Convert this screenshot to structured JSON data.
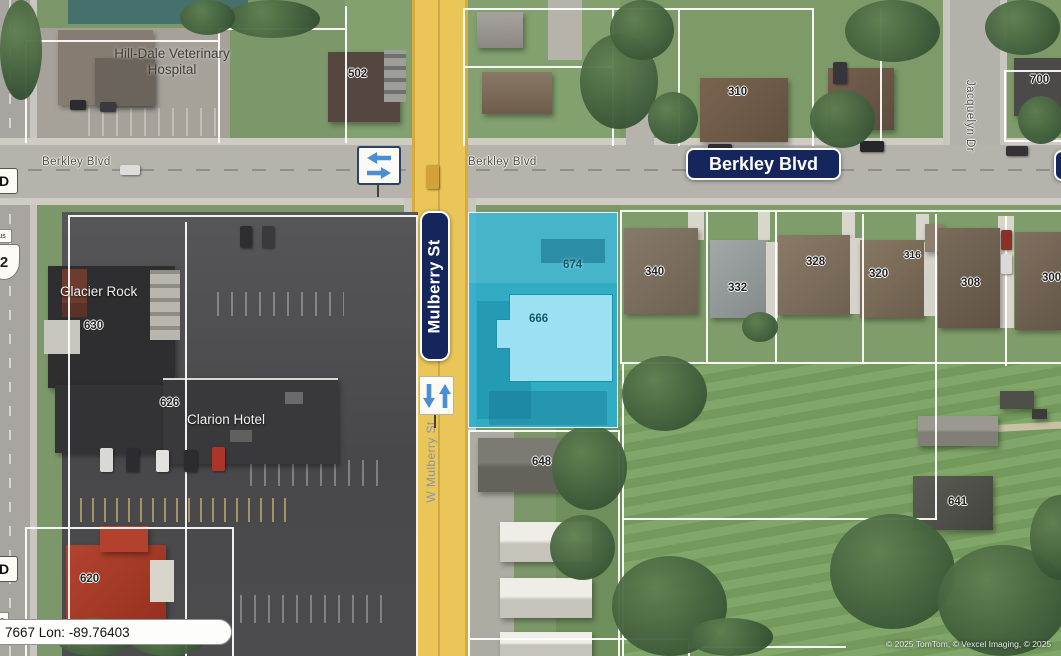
{
  "map_labels": {
    "vet_hospital_line1": "Hill-Dale Veterinary",
    "vet_hospital_line2": "Hospital",
    "glacier_rock": "Glacier Rock",
    "clarion_hotel": "Clarion Hotel"
  },
  "street_signs": {
    "berkley_blvd_sign": "Berkley Blvd",
    "mulberry_st_sign": "Mulberry St"
  },
  "road_labels": {
    "berkley_blvd_left": "Berkley Blvd",
    "berkley_blvd_center": "Berkley Blvd",
    "w_mulberry_st": "W Mulberry St",
    "jacquelyn_dr": "Jacquelyn Dr"
  },
  "edge_markers": {
    "d_marker_top": "D",
    "d_marker_bottom": "D",
    "us_route_shield_number": "2",
    "us_route_caption_top": "us",
    "us_route_caption_bottom": "us"
  },
  "parcel_numbers": {
    "p502": "502",
    "p310": "310",
    "p700": "700",
    "p340": "340",
    "p332": "332",
    "p328": "328",
    "p320": "320",
    "p316": "316",
    "p308": "308",
    "p300": "300",
    "p648": "648",
    "p641": "641",
    "p630": "630",
    "p626": "626",
    "p620": "620"
  },
  "selected_parcel": {
    "parcel_number": "674",
    "building_number": "666",
    "highlight_fill": "#2bb0d1",
    "building_fill": "#9be1f2"
  },
  "status": {
    "coordinates_readout": "7667 Lon: -89.76403"
  },
  "attribution": {
    "copyright": "© 2025 TomTom, © Vexcel Imaging, © 2025"
  },
  "theme": {
    "street_sign_bg": "#14265c",
    "street_sign_text": "#ffffff",
    "arrow_blue": "#4a8fd4",
    "parcel_line": "#ffffff",
    "road_yellow": "#eac658"
  }
}
